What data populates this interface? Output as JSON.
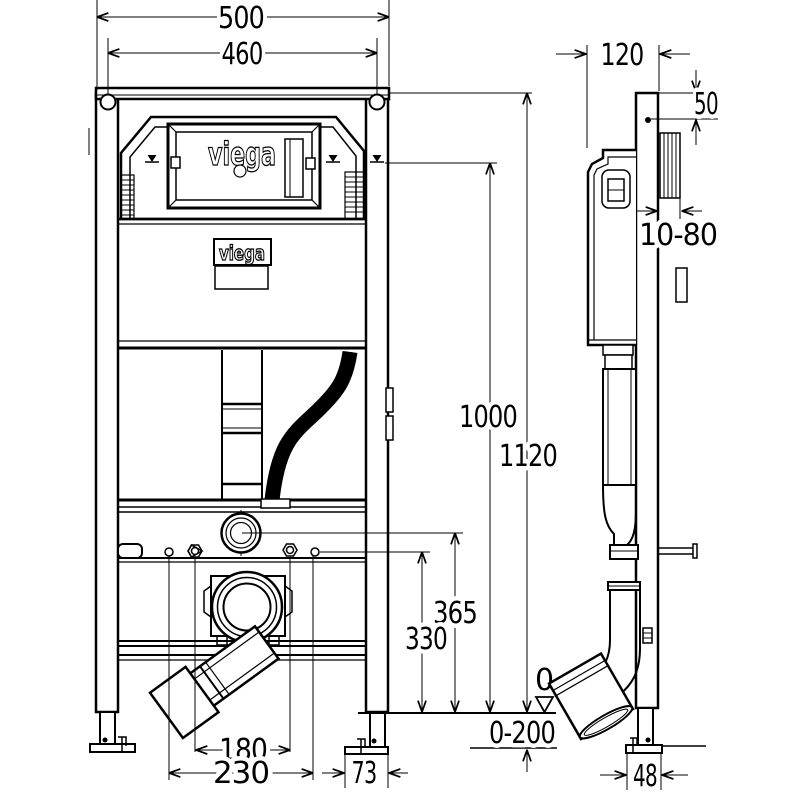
{
  "drawing": {
    "title": "wall-mounted-cistern-frame-technical-drawing",
    "brand": {
      "logo_main": "viega",
      "logo_label": "viega"
    },
    "colors": {
      "line": "#000000",
      "background": "#ffffff"
    },
    "front_view": {
      "dims": {
        "total_width": "500",
        "anchor_spacing": "460",
        "top_mark_height": "1000",
        "frame_height": "1120",
        "flush_center_height": "365",
        "bolt_height": "330",
        "outlet_spacing": "180",
        "outlet_width": "230",
        "foot_plate_offset": "73",
        "floor_level": "0",
        "floor_adjustment": "0-200"
      }
    },
    "side_view": {
      "dims": {
        "frame_depth": "120",
        "anchor_offset": "50",
        "wall_clearance": "10-80",
        "foot_width": "48"
      }
    }
  }
}
